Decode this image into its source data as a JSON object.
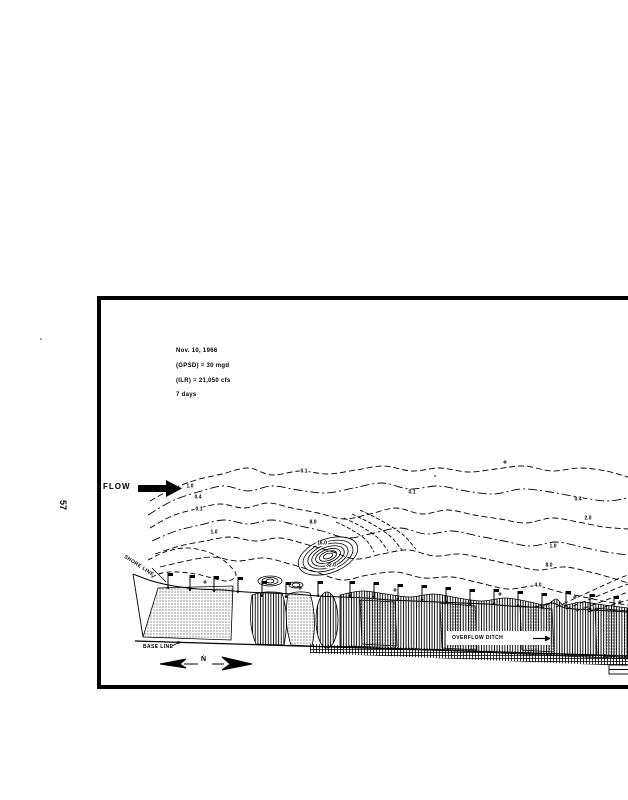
{
  "page": {
    "page_number": "57"
  },
  "figure": {
    "annotations": {
      "line1": "Nov. 10, 1966",
      "line2": "(GPSD) = 30 mgd",
      "line3": "(ILR) = 21,050 cfs",
      "line4": "7 days"
    },
    "labels": {
      "flow": "FLOW",
      "shore_line": "SHORE LINE",
      "base_line": "BASE LINE",
      "overflow_ditch": "OVERFLOW DITCH",
      "north": "Ṅ",
      "scale_zero": "0"
    },
    "contour_labels": [
      {
        "t": "1.0",
        "x": 190,
        "y": 487
      },
      {
        "t": "0.4",
        "x": 198,
        "y": 498
      },
      {
        "t": "0.1",
        "x": 199,
        "y": 510
      },
      {
        "t": "0.1",
        "x": 304,
        "y": 472
      },
      {
        "t": "1.0",
        "x": 214,
        "y": 533
      },
      {
        "t": "8.0",
        "x": 313,
        "y": 523
      },
      {
        "t": "16.0",
        "x": 322,
        "y": 544
      },
      {
        "t": "32.0",
        "x": 331,
        "y": 566
      },
      {
        "t": "0.1",
        "x": 412,
        "y": 493
      },
      {
        "t": "0.4",
        "x": 578,
        "y": 500
      },
      {
        "t": "2.0",
        "x": 588,
        "y": 519
      },
      {
        "t": "1.0",
        "x": 553,
        "y": 547
      },
      {
        "t": "8.0",
        "x": 549,
        "y": 566
      },
      {
        "t": "4.0",
        "x": 538,
        "y": 586
      }
    ],
    "station_markers": [
      [
        168,
        584
      ],
      [
        190,
        586
      ],
      [
        214,
        587
      ],
      [
        238,
        588
      ],
      [
        262,
        592
      ],
      [
        286,
        593
      ],
      [
        318,
        592
      ],
      [
        350,
        592
      ],
      [
        374,
        593
      ],
      [
        398,
        595
      ],
      [
        422,
        596
      ],
      [
        446,
        598
      ],
      [
        470,
        600
      ],
      [
        494,
        600
      ],
      [
        518,
        602
      ],
      [
        542,
        604
      ],
      [
        566,
        602
      ],
      [
        590,
        605
      ],
      [
        614,
        607
      ]
    ],
    "plus_marks": [
      [
        205,
        582
      ],
      [
        300,
        588
      ],
      [
        395,
        590
      ],
      [
        500,
        594
      ],
      [
        575,
        597
      ],
      [
        620,
        602
      ],
      [
        505,
        462
      ]
    ]
  }
}
